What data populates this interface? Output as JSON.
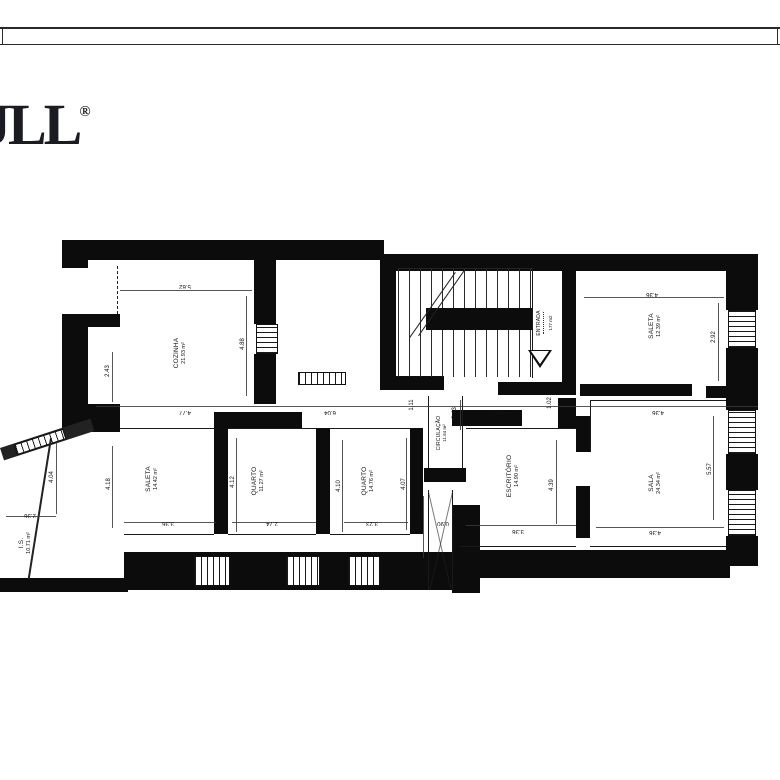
{
  "brand": {
    "name": "JLL",
    "reg": "®"
  },
  "plan": {
    "rooms": [
      {
        "name": "COZINHA",
        "area": "21.93 m²"
      },
      {
        "name": "SALETA",
        "area": "12.39 m²"
      },
      {
        "name": "ENTRADA",
        "area": "177 m2"
      },
      {
        "name": "CIRCULAÇÃO",
        "area": "11.64 m²"
      },
      {
        "name": "I.S.",
        "area": "10.71 m²"
      },
      {
        "name": "SALETA",
        "area": "14.42 m²"
      },
      {
        "name": "QUARTO",
        "area": "11.27 m²"
      },
      {
        "name": "QUARTO",
        "area": "14.76 m²"
      },
      {
        "name": "ESCRITÓRIO",
        "area": "14.90 m²"
      },
      {
        "name": "SALA",
        "area": "24.34 m²"
      }
    ],
    "dims": {
      "cozinha_w": "5.62",
      "cozinha_h": "4.88",
      "cozinha_l": "2.43",
      "mid_1": "4.77",
      "mid_2": "6.04",
      "mid_3": "1.11",
      "mid_4": "4.51",
      "mid_5": "1.02",
      "mid_6": "4.36",
      "saleta_top_w": "4.36",
      "saleta_top_h": "2.92",
      "circ_h": "2.43",
      "is_w": "2.36",
      "is_h": "4.04",
      "v418": "4.18",
      "v412": "4.12",
      "v410": "4.10",
      "v407": "4.07",
      "saleta_w": "3.36",
      "quarto1_w": "2.74",
      "quarto2_w": "3.23",
      "shaft_h": "3.09",
      "shaft_w": "0.90",
      "escritorio_w": "3.36",
      "escritorio_h": "4.39",
      "sala_bottom": "4.36",
      "sala_h": "5.57"
    }
  }
}
